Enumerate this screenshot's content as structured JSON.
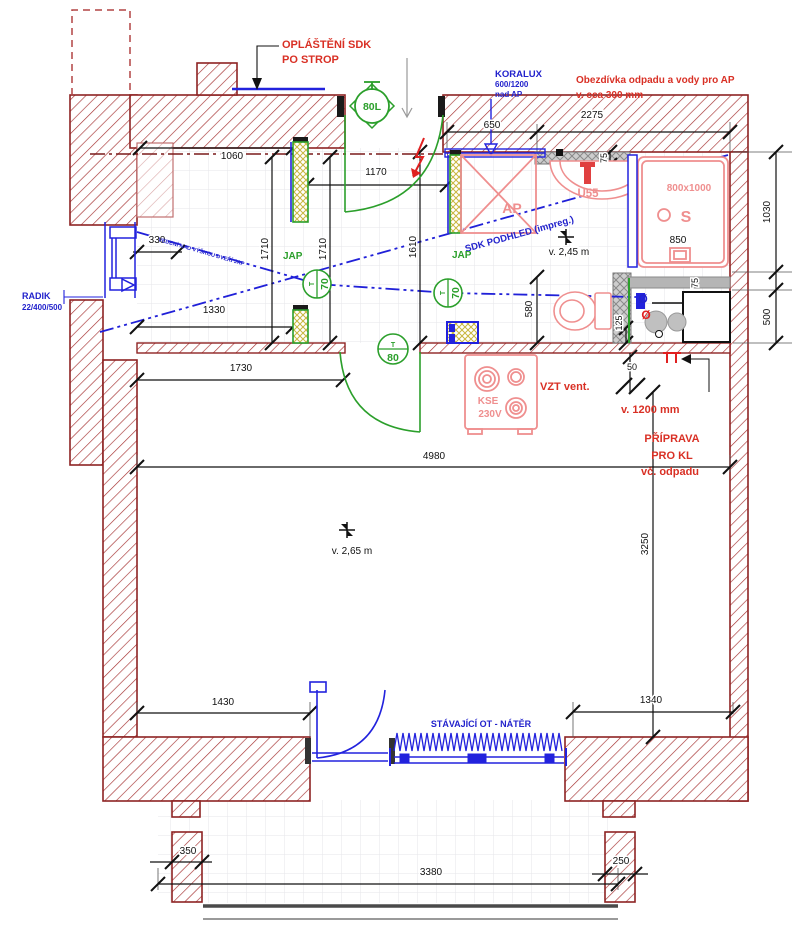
{
  "drawing": {
    "type": "architectural floor plan (bathroom / kitchen refurbishment)",
    "colors": {
      "wall": "#8e2323",
      "wall_hatch": "#a63232",
      "dimension": "#111111",
      "annotation_red": "#d93025",
      "annotation_blue": "#2222cc",
      "fixture_pink": "#ef8f8f",
      "door_green": "#2b9f2b",
      "window_blue": "#2222dd",
      "tile_grid": "#e6e6ea",
      "gray_band": "#b5b5b5"
    },
    "annotations": {
      "oplasteni_1": "OPLÁŠTĚNÍ SDK",
      "oplasteni_2": "PO STROP",
      "koralux_1": "KORALUX",
      "koralux_2": "600/1200",
      "koralux_3": "nad AP",
      "obezdivka_1": "Obezdívka odpadu a vody pro AP",
      "obezdivka_2": "v. cca 300 mm",
      "radik_1": "RADIK",
      "radik_2": "22/400/500",
      "sdk_podhled": "SDK PODHLED (impreg.)",
      "pipe_note": "VEDENÍ NAD VÝŠKOU DVEŘÍ JAP",
      "vzt": "VZT vent.",
      "v1200": "v. 1200 mm",
      "priprava_1": "PŘÍPRAVA",
      "priprava_2": "PRO KL",
      "priprava_3": "vč. odpadu",
      "stavajici_ot": "STÁVAJÍCÍ OT - NÁTĚR",
      "height_245": "v. 2,45 m",
      "height_265": "v. 2,65 m"
    },
    "fixtures": {
      "ap": "AP",
      "washbasin": "U55",
      "shower_size": "800x1000",
      "shower": "S",
      "shower_width": "850",
      "boiler": "80L",
      "stove_1": "KSE",
      "stove_2": "230V",
      "jap_left": "JAP",
      "jap_right": "JAP",
      "door_left": "70",
      "door_right": "70",
      "door_living": "80",
      "door_t": "T",
      "valve_blue": "Ø",
      "valve_red": "Ø"
    },
    "dimensions": {
      "d1060": "1060",
      "d1170": "1170",
      "d650": "650",
      "d2275": "2275",
      "d75_top": "75",
      "d1030": "1030",
      "d500": "500",
      "d330": "330",
      "d1710a": "1710",
      "d1710b": "1710",
      "d1610": "1610",
      "d1330": "1330",
      "d580": "580",
      "d125": "125",
      "d50": "50",
      "d75_kitchen": "75",
      "d1730": "1730",
      "d4980": "4980",
      "d3250": "3250",
      "d1430": "1430",
      "d1340": "1340",
      "d350": "350",
      "d3380": "3380",
      "d250": "250"
    }
  }
}
